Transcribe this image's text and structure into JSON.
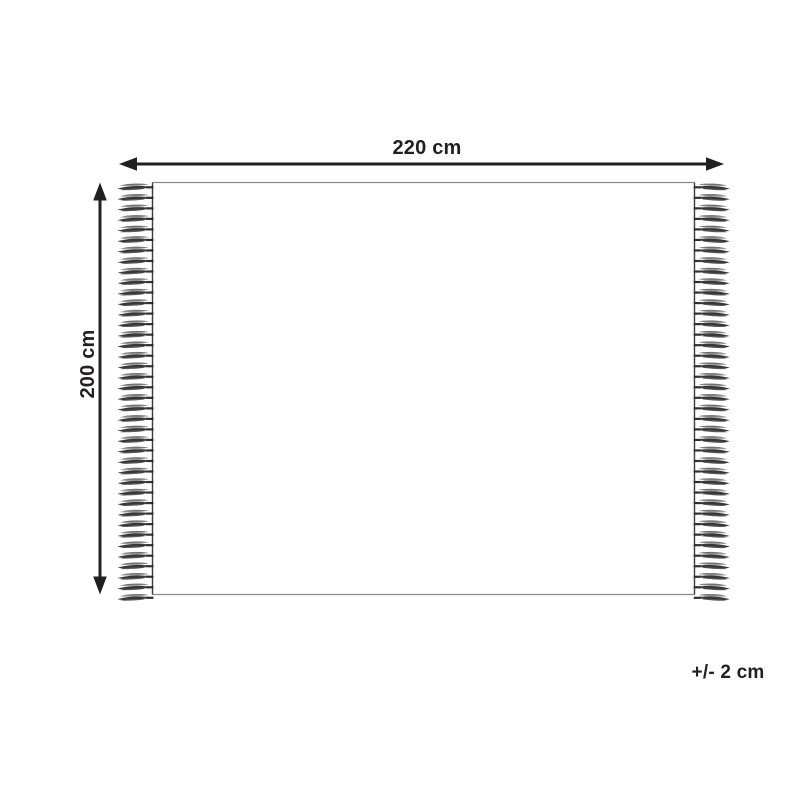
{
  "diagram": {
    "type": "product-dimension-diagram",
    "product": "fringed rug / throw blanket",
    "width_label": "220 cm",
    "height_label": "200 cm",
    "tolerance_label": "+/- 2 cm",
    "fringes_per_side": 40,
    "colors": {
      "ink": "#231f20",
      "outline_light": "#8a8a8a",
      "outline_dark": "#3a3a3a",
      "tassel_dark": "#383838",
      "tassel_mid": "#5a5a5a",
      "tassel_light": "#9a9a9a",
      "background": "#ffffff"
    }
  }
}
